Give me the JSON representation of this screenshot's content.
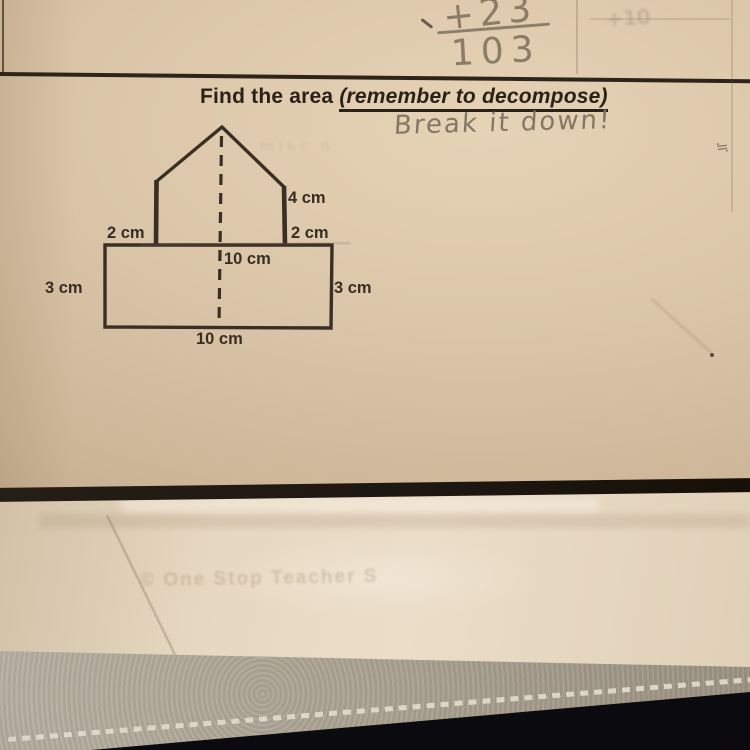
{
  "photo": {
    "scratch_work": {
      "numerator": "+23",
      "denominator": "103"
    },
    "header": {
      "title_prefix": "Find the area ",
      "title_emphasis": "(remember to decompose)"
    },
    "annotation": {
      "text": "Break it down!",
      "scribble": "≒"
    },
    "figure": {
      "labels": {
        "slant_right": "4 cm",
        "upper_right": "2 cm",
        "upper_left": "2 cm",
        "center_height": "10 cm",
        "left_side": "3 cm",
        "right_side": "3 cm",
        "bottom": "10 cm"
      }
    },
    "bleed_through": {
      "footer": "© One Stop Teacher S",
      "top_fragment": "+10",
      "side_fragment": "misc o"
    },
    "colors": {
      "paper": "#d9c4a7",
      "ink": "#2b2118",
      "pencil": "#82745f",
      "under_paper": "#e6d7c0",
      "leather": "#aca393",
      "background": "#0b0a0e"
    }
  }
}
